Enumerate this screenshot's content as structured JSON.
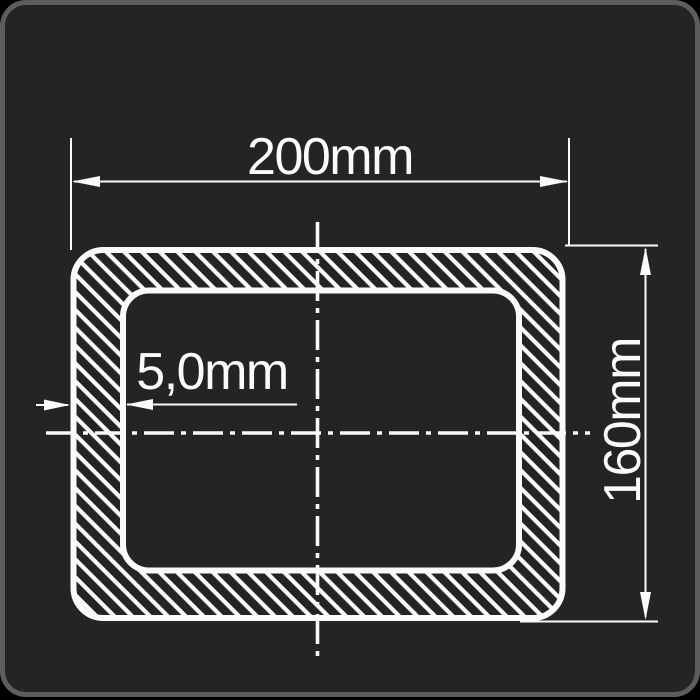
{
  "drawing": {
    "title": "rectangular-hollow-section-cross-section",
    "dimensions": {
      "width_label": "200mm",
      "height_label": "160mm",
      "wall_thickness_label": "5,0mm"
    },
    "colors": {
      "canvas_bg": "#000000",
      "card_bg": "#252323",
      "card_border": "#5d5d5d",
      "line": "#fafafa"
    }
  }
}
